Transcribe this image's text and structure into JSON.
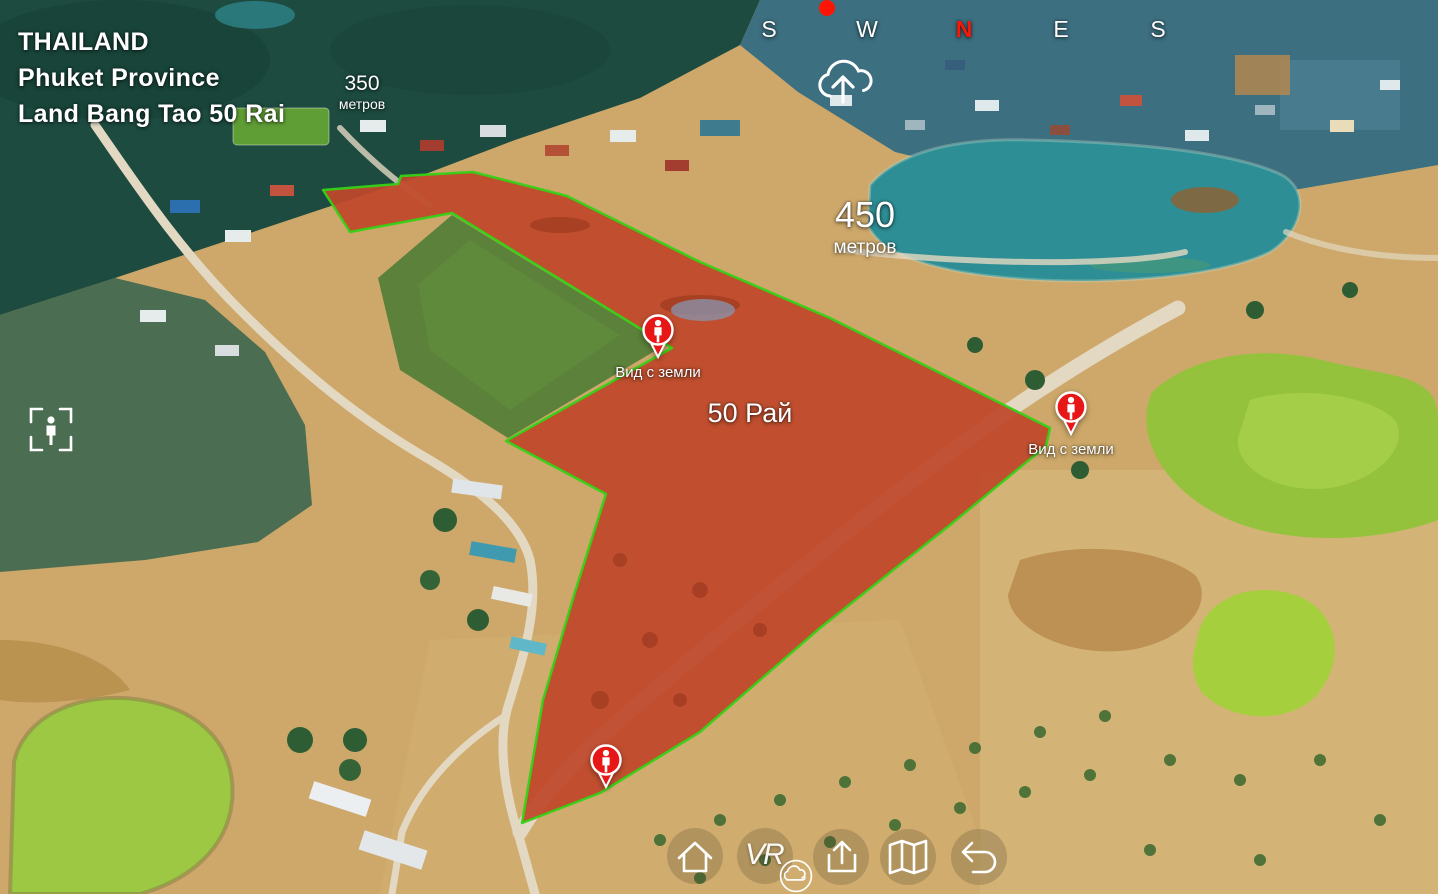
{
  "location": {
    "country": "THAILAND",
    "province": "Phuket Province",
    "title": "Land Bang Tao 50 Rai"
  },
  "labels": {
    "area": "50 Рай",
    "distance_near": {
      "value": "350",
      "unit": "метров"
    },
    "distance_far": {
      "value": "450",
      "unit": "метров"
    }
  },
  "compass": {
    "letters": [
      "S",
      "W",
      "N",
      "E",
      "S"
    ],
    "letter_color": "#ffffff",
    "north_color": "#ff1505",
    "indicator_dot_color": "#ff1505"
  },
  "markers": [
    {
      "name": "ground-view-marker-center",
      "label": "Вид с земли"
    },
    {
      "name": "ground-view-marker-right",
      "label": "Вид с земли"
    },
    {
      "name": "ground-view-marker-bottom",
      "label": ""
    }
  ],
  "tools": {
    "top_icon": "cloud-upload-icon",
    "left_icon": "person-in-frame-icon"
  },
  "toolbar": {
    "vr_label": "VR",
    "items": [
      "home-icon",
      "vr-icon",
      "cloud-icon",
      "upload-icon",
      "map-icon",
      "undo-icon"
    ]
  },
  "colors": {
    "plot_fill": "#e03418",
    "plot_border": "#35d216",
    "marker_red": "#e81717",
    "text": "#ffffff"
  }
}
